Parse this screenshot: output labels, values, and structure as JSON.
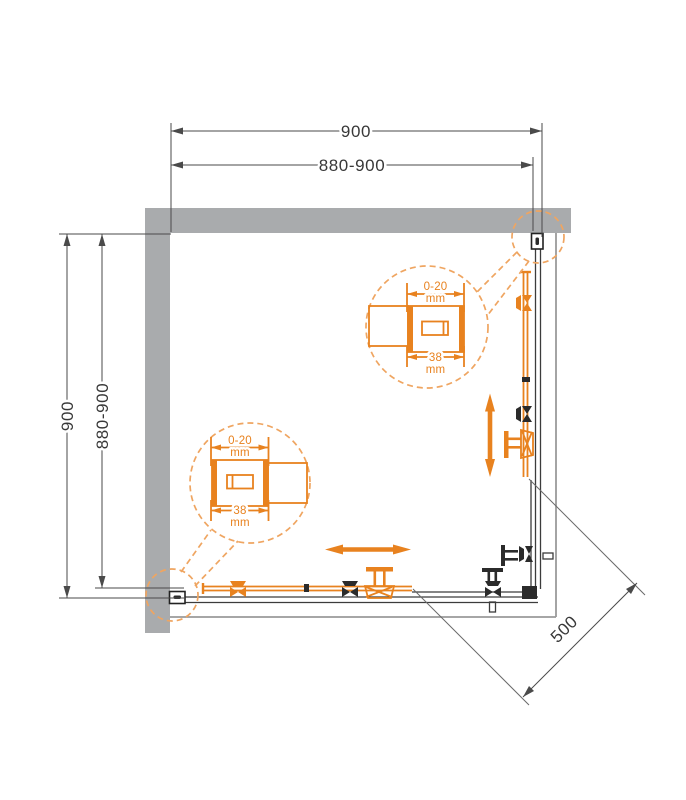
{
  "diagram": {
    "subject": "corner shower enclosure top view with sliding doors",
    "dims": {
      "top_overall": "900",
      "top_adjustable": "880-900",
      "left_overall": "900",
      "left_adjustable": "880-900",
      "entry_width": "500"
    },
    "detail_top": {
      "range_value": "0-20",
      "range_unit": "mm",
      "width_value": "38",
      "width_unit": "mm"
    },
    "detail_bottom": {
      "range_value": "0-20",
      "range_unit": "mm",
      "width_value": "38",
      "width_unit": "mm"
    },
    "colors": {
      "accent_orange": "#E8821F",
      "dashed_orange": "#EFA561",
      "wall_gray": "#A9ABAD",
      "line_dark": "#3A3A3A",
      "tray_gray": "#9A9A9A"
    }
  }
}
